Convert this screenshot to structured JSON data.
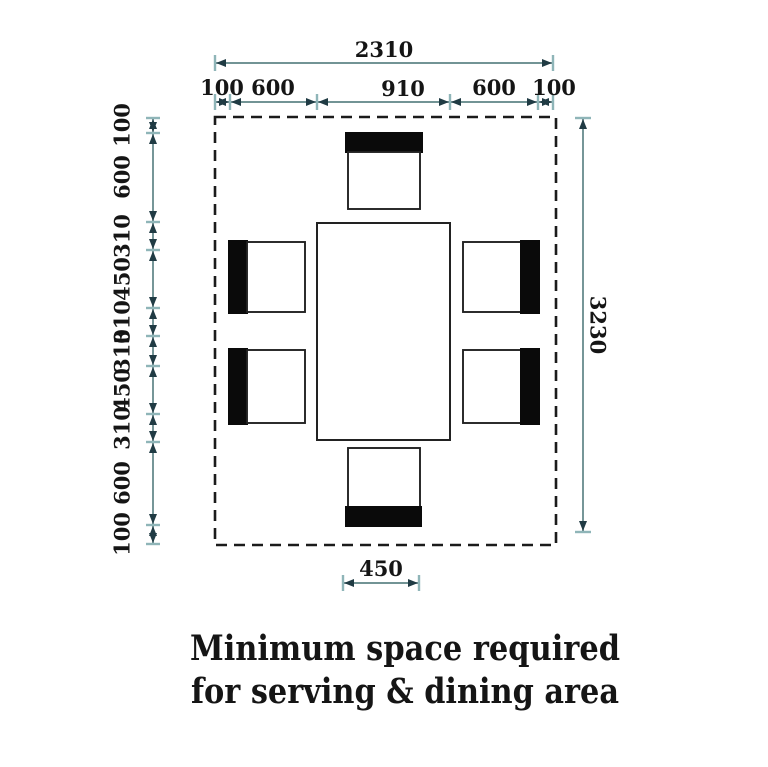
{
  "figure": {
    "caption_line1": "Minimum space required",
    "caption_line2": "for serving & dining area"
  },
  "dimensions": {
    "overall_width": "2310",
    "top_segments": [
      "100",
      "600",
      "910",
      "600",
      "100"
    ],
    "overall_height": "3230",
    "left_segments": [
      "100",
      "600",
      "310",
      "450",
      "310",
      "310",
      "450",
      "310",
      "600",
      "100"
    ],
    "chair_clearance": "450"
  },
  "colors": {
    "dim_line": "#5e8486",
    "dim_tick": "#8fb5b8",
    "dim_arrow": "#203b44",
    "outline": "#222222",
    "dashed": "#1b1b1b",
    "chair_black": "#0a0a0a",
    "text": "#151515",
    "bg": "#ffffff"
  }
}
